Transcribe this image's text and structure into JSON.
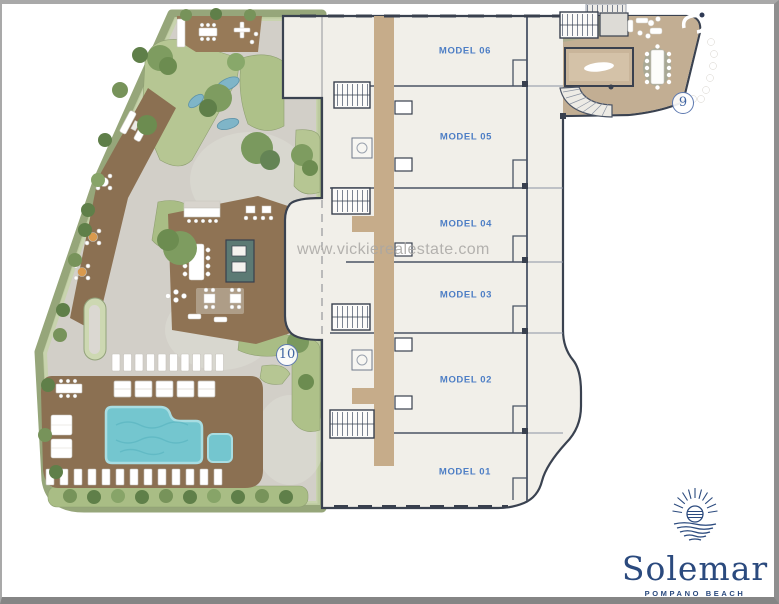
{
  "watermark": {
    "text": "www.vickierealestate.com"
  },
  "plan": {
    "units": [
      {
        "id": "model-06",
        "label": "MODEL 06"
      },
      {
        "id": "model-05",
        "label": "MODEL 05"
      },
      {
        "id": "model-04",
        "label": "MODEL 04"
      },
      {
        "id": "model-03",
        "label": "MODEL 03"
      },
      {
        "id": "model-02",
        "label": "MODEL 02"
      },
      {
        "id": "model-01",
        "label": "MODEL 01"
      }
    ],
    "markers": [
      {
        "number": "9"
      },
      {
        "number": "10"
      }
    ]
  },
  "logo": {
    "name": "Solemar",
    "subtitle": "POMPANO BEACH"
  },
  "colors": {
    "brand_navy": "#2b4a7e",
    "label_blue": "#4d7ec5",
    "wall_dark": "#3a4250",
    "unit_floor": "#f1efe9",
    "corridor_tan": "#c6ac8a",
    "amenity_deck": "#c2ae93",
    "pool_deck_brown": "#8b7052",
    "pool_water": "#74c6cf",
    "path_gray": "#d2cfc8",
    "garden_green": "#b3c48e",
    "hedge_green": "#96a67a",
    "watermark_gray": "#a9a7a4"
  }
}
